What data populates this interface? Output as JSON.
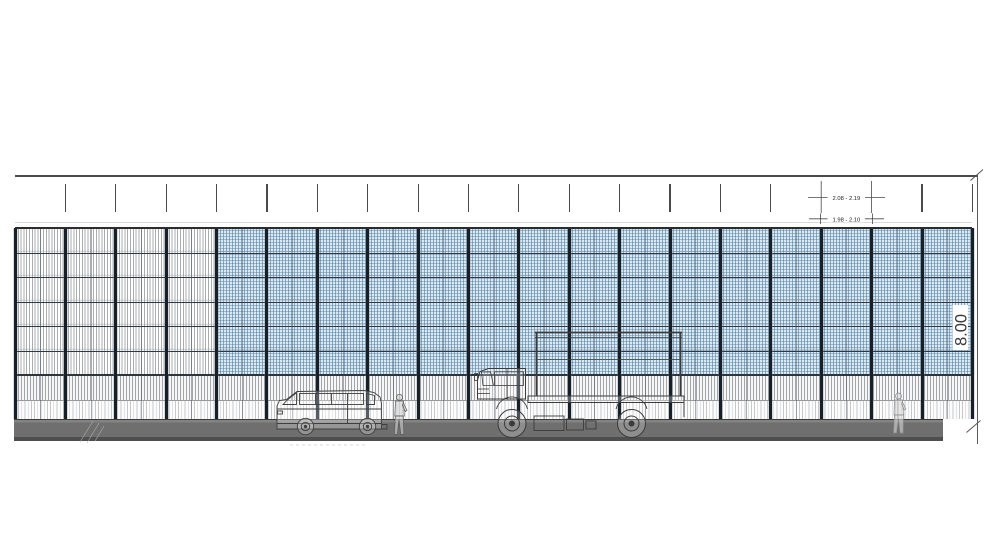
{
  "drawing": {
    "kind": "noise-barrier-wall-elevation",
    "annotations": {
      "wall_height": "8.00",
      "panel_width_range_top": "2.08 - 2.19",
      "panel_width_range_bottom": "1.98 - 2.10"
    }
  },
  "wall": {
    "bay_count": 19,
    "gray_bay_count": 4,
    "blue_bay_count": 15,
    "row_count": 6,
    "colors": {
      "blue_panel_fill": "#dae8f2",
      "blue_hatch_line": "#4f87ad",
      "gray_hatch_line": "#8e9499",
      "post": "#171f29",
      "row_line": "#2f3842"
    }
  },
  "ground": {
    "road_color": "#6f6f6f",
    "curb_shadow_color": "#4e4e4e"
  },
  "scene": {
    "vehicles": [
      "van",
      "flatbed-truck"
    ],
    "pedestrian_count": 2
  }
}
